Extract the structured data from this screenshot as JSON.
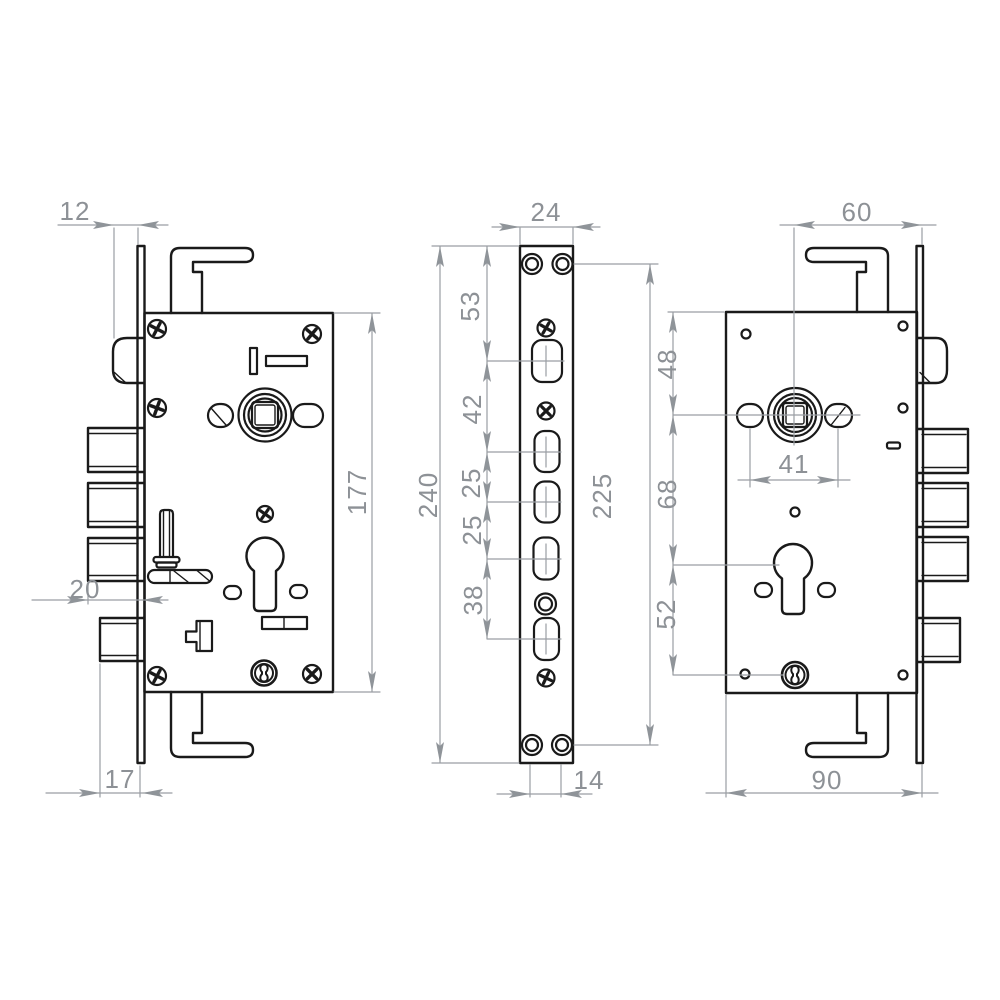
{
  "drawing": {
    "background": "#ffffff",
    "part_line_color": "#1a1a1a",
    "dimension_color": "#8d9196"
  },
  "dims": {
    "left_view": {
      "latch_protrusion": "12",
      "deadbolt_protrusion": "20",
      "lower_bolt_protrusion": "17",
      "body_height": "177"
    },
    "middle_view": {
      "faceplate_width": "24",
      "faceplate_length": "240",
      "spacing_top_to_latch": "53",
      "spacing_latch_to_bolt1": "42",
      "spacing_bolt1_to_bolt2": "25",
      "spacing_bolt2_to_bolt3": "25",
      "spacing_bolt3_to_lower_bolt": "38",
      "screw_hole_spacing": "225",
      "bottom_tab_width": "14"
    },
    "right_view": {
      "backset": "60",
      "top_to_spindle": "48",
      "spindle_to_cylinder": "68",
      "cylinder_to_adjuster": "52",
      "handle_hole_spacing": "41",
      "body_width": "90"
    }
  }
}
